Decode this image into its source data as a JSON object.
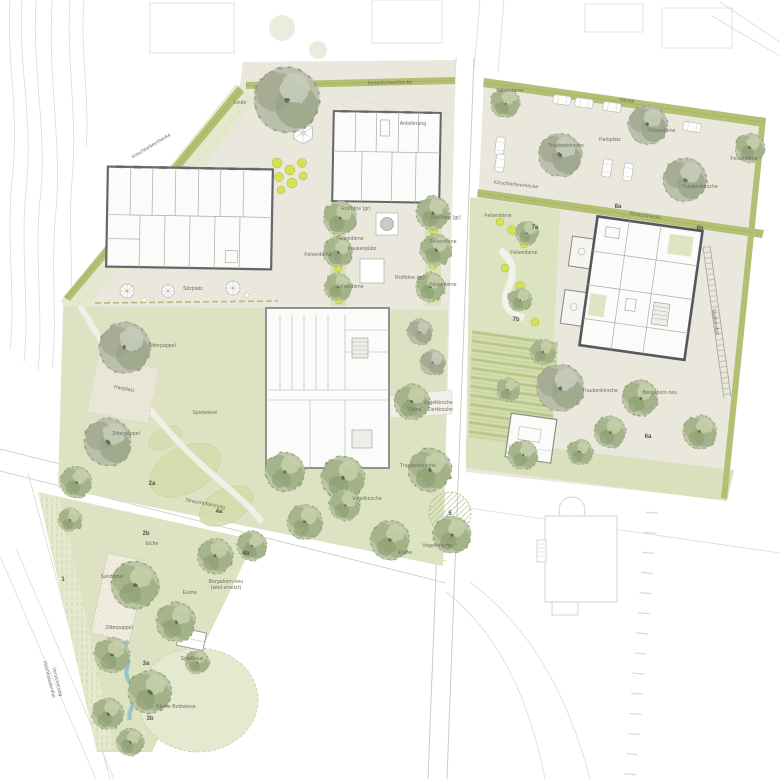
{
  "plan": {
    "labels": {
      "linde": "Linde",
      "anlieferung": "Anlieferung",
      "hedge_top": "Kirschlorbeerhecke",
      "hedge_topleft": "Kirschlorbeerhecke",
      "hedge_mid": "Kirschlorbeerhecke",
      "hecke": "Hecke",
      "strauchhecke": "Strauchhecke",
      "sitzplatz": "Sitzplatz",
      "pausenplatz": "Pausenplatz",
      "parkplatz": "Parkplatz",
      "felsenbirne": "Felsenbirne",
      "rotfoehre": "Rotföhre (gr)",
      "spielwiese": "Spielwiese",
      "hartplatz": "Hartplatz",
      "zitterpappel": "Zitterpappel",
      "eiche": "Eiche",
      "esche": "Esche",
      "vogelkirsche": "Vogelkirsche",
      "vogelkirsche2": "'Plena' - Zierkirsche",
      "traubenkirsche": "Traubenkirsche",
      "spalier": "Spalierobst",
      "sandspiel": "Sandspiel",
      "spielhaus": "Spielhaus",
      "bolzwiese": "Kleine Bolzwiese",
      "hochstaudenflur": "Hochstaudenflur",
      "versickerung": "Versickerung",
      "strauchpflanzung": "Strauchpflanzung",
      "bergahorn": "Bergahorn neu",
      "bergahorn2": "(wird ersetzt)"
    },
    "markers": {
      "m1": "1",
      "m2a": "2a",
      "m2b": "2b",
      "m3a": "3a",
      "m3b": "3b",
      "m4a": "4a",
      "m4b": "4b",
      "m5": "5",
      "m6a": "6a",
      "m7a": "7a",
      "m7b": "7b",
      "m8a": "8a",
      "m8b": "8b"
    },
    "colors": {
      "parcel": "#eae7dc",
      "lawn": "#dde3c2",
      "lawn_dark": "#d2dcab",
      "hedge": "#b3bf72",
      "shrub": "#d8e056",
      "water": "#9ec7ce",
      "wall": "#63676a",
      "wall_dark": "#55585c",
      "faint": "#dcddd8",
      "text": "#6c6c5f"
    }
  }
}
